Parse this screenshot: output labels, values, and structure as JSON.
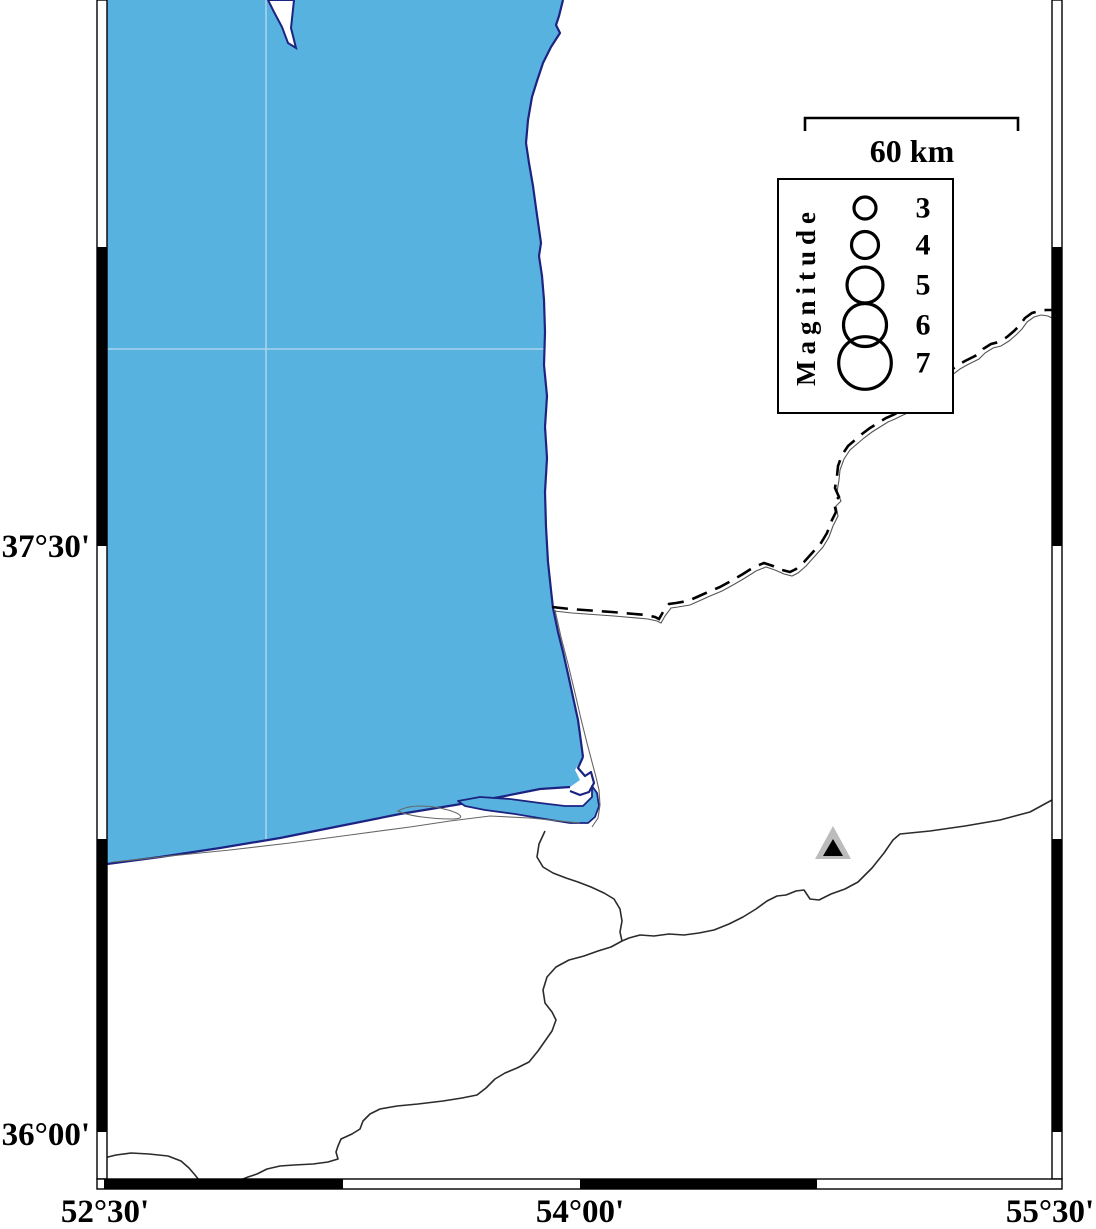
{
  "frame": {
    "lat_labels": [
      {
        "text": "37°30'"
      },
      {
        "text": "36°00'"
      }
    ],
    "lon_labels": [
      {
        "text": "52°30'"
      },
      {
        "text": "54°00'"
      },
      {
        "text": "55°30'"
      }
    ]
  },
  "legend": {
    "title": "Magnitude",
    "entries": [
      {
        "magnitude": "3"
      },
      {
        "magnitude": "4"
      },
      {
        "magnitude": "5"
      },
      {
        "magnitude": "6"
      },
      {
        "magnitude": "7"
      }
    ]
  },
  "scale_bar": {
    "label": "60 km"
  },
  "markers": {
    "station_triangle": "seismic-station"
  },
  "colors": {
    "sea": "#58b2e0",
    "grid_line": "#a9d3ee",
    "coastline": "#1c2380",
    "political_border": "#000000",
    "river": "#2b2b2b",
    "shoreline_detail": "#666666",
    "triangle_fill": "#bcbcbc",
    "triangle_core": "#000000",
    "frame": "#000000",
    "land": "#ffffff"
  }
}
